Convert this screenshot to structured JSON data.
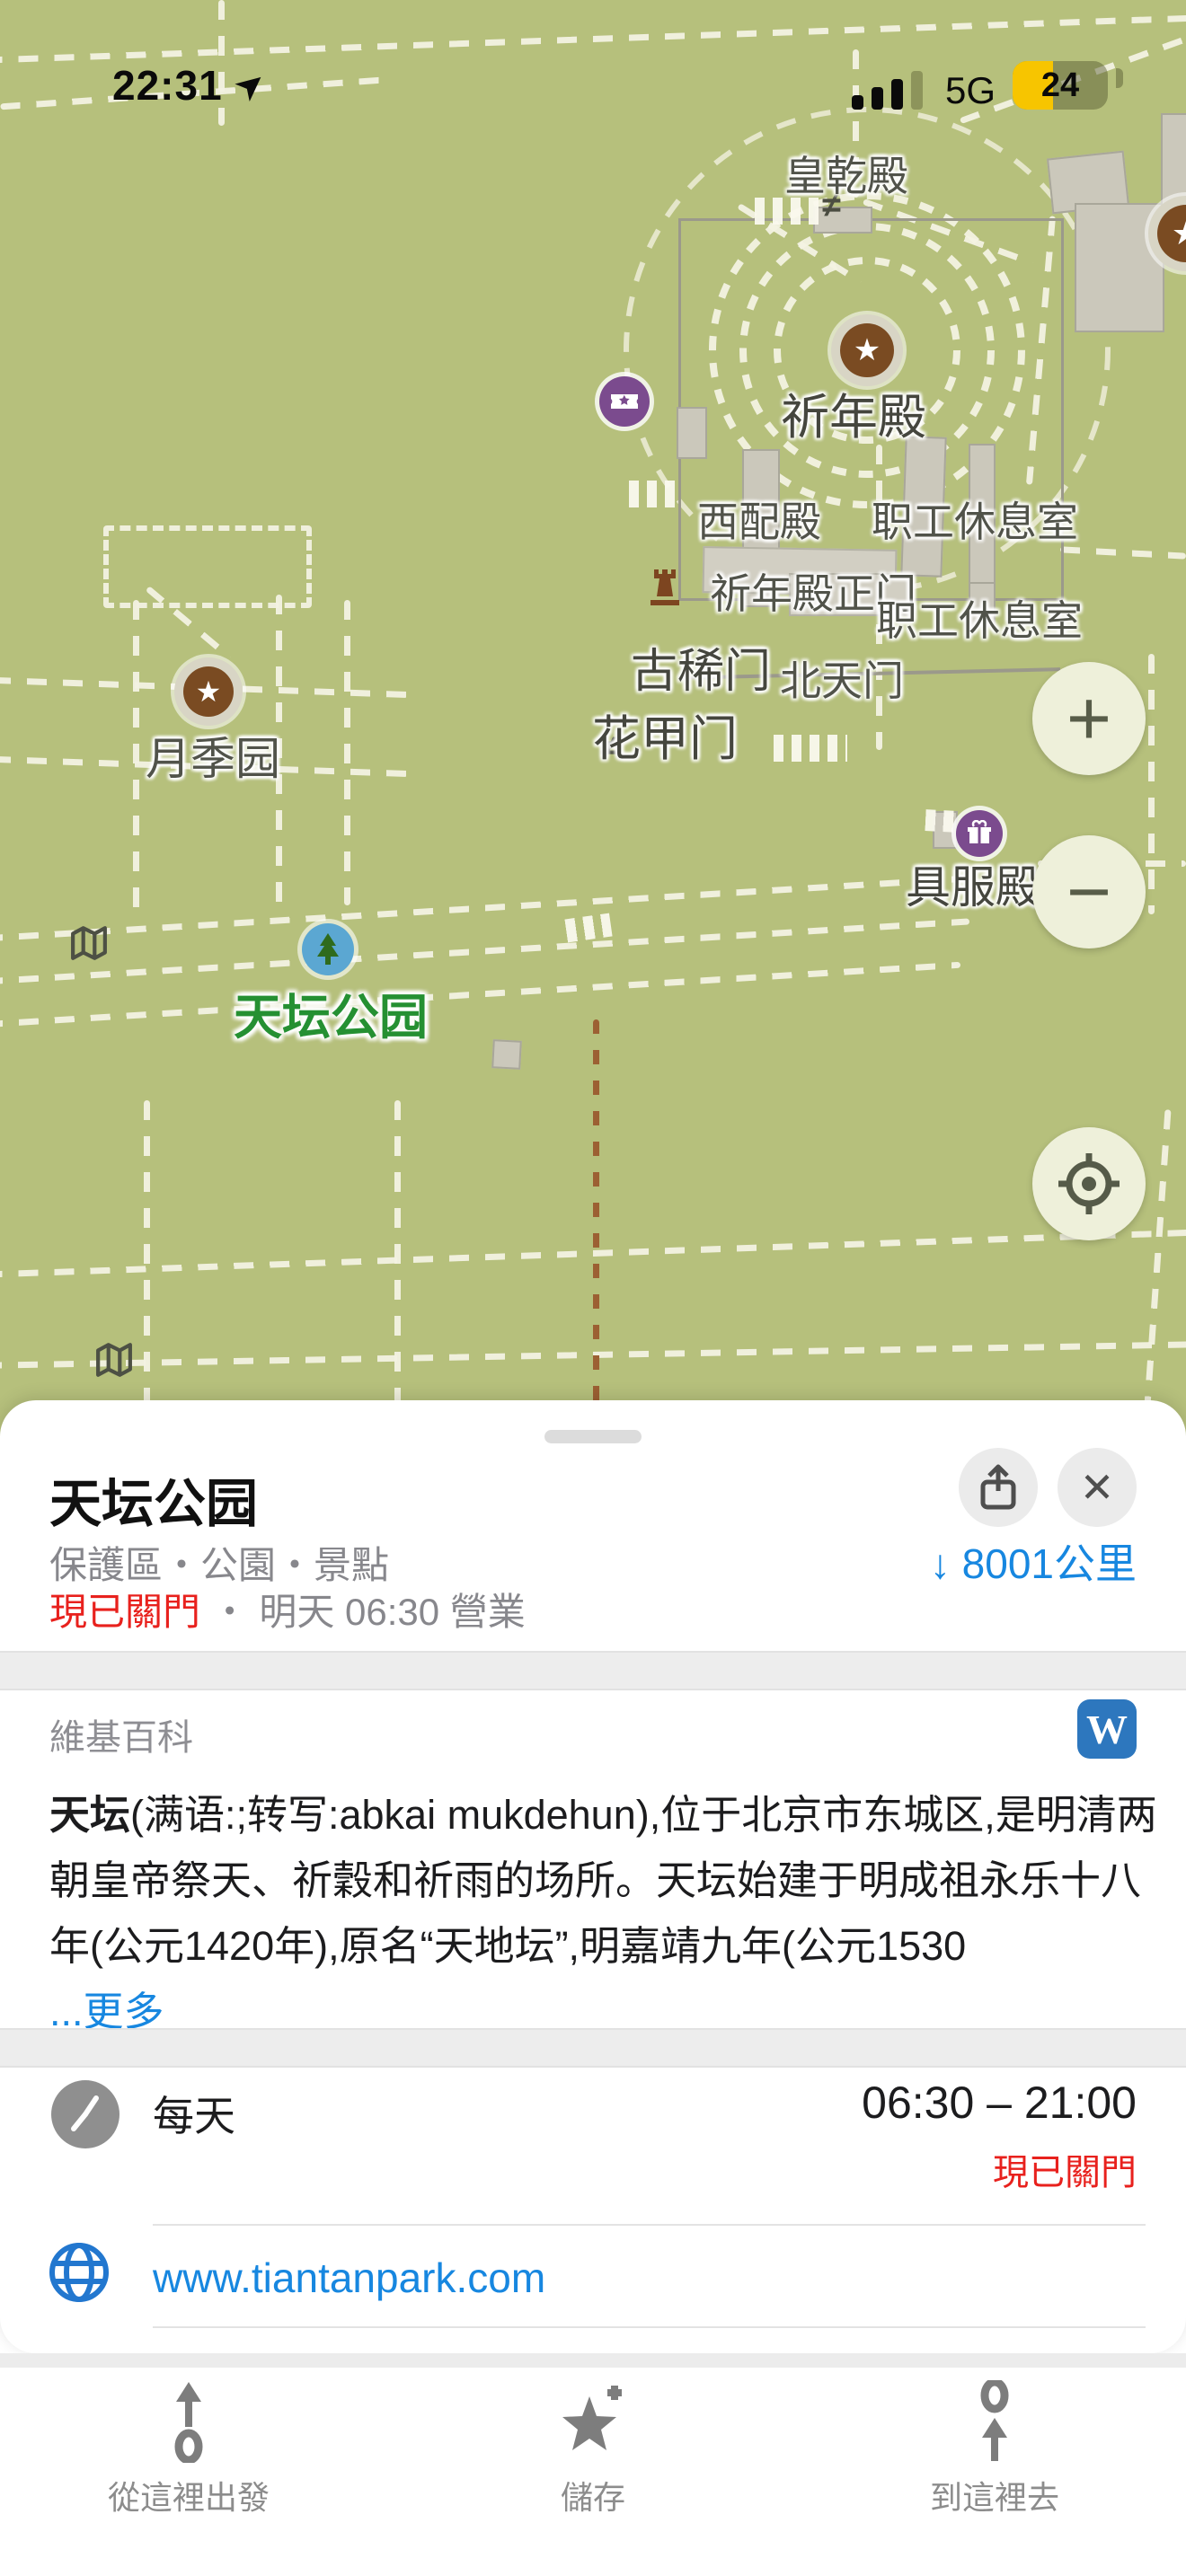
{
  "status_bar": {
    "time": "22:31",
    "network": "5G",
    "battery_percent": "24"
  },
  "map": {
    "place_labels": [
      {
        "text": "皇乾殿"
      },
      {
        "text": "祈年殿"
      },
      {
        "text": "西配殿"
      },
      {
        "text": "职工休息室"
      },
      {
        "text": "祈年殿正门"
      },
      {
        "text": "职工休息室"
      },
      {
        "text": "古稀门"
      },
      {
        "text": "北天门"
      },
      {
        "text": "花甲门"
      },
      {
        "text": "月季园"
      },
      {
        "text": "具服殿"
      }
    ],
    "park_label": "天坛公园",
    "neq_glyph": "≠",
    "star_glyph": "★",
    "controls": {
      "zoom_in": "+",
      "zoom_out": "−"
    }
  },
  "sheet": {
    "title": "天坛公园",
    "category": "保護區・公園・景點",
    "distance": {
      "arrow": "↓",
      "value": "8001公里"
    },
    "status": {
      "closed": "現已關門",
      "sep": " ・ ",
      "open_info": "明天 06:30 營業"
    },
    "wiki": {
      "heading": "維基百科",
      "w_letter": "W",
      "term": "天坛",
      "text_rest": "(满语:;转写:abkai mukdehun),位于北京市东城区,是明清两朝皇帝祭天、祈穀和祈雨的场所。天坛始建于明成祖永乐十八年(公元1420年),原名“天地坛”,明嘉靖九年(公元1530",
      "more": "...更多"
    },
    "hours": {
      "days": "每天",
      "range": "06:30 – 21:00",
      "status": "現已關門"
    },
    "website": "www.tiantanpark.com",
    "close_glyph": "✕"
  },
  "toolbar": {
    "items": [
      {
        "label": "從這裡出發"
      },
      {
        "label": "儲存"
      },
      {
        "label": "到這裡去"
      }
    ]
  },
  "colors": {
    "map_bg": "#b6c07c",
    "link_blue": "#1787e0",
    "closed_red": "#e8211d",
    "wiki_blue": "#2d77be",
    "poi_brown": "#7a4b22",
    "poi_purple": "#7b4b8e",
    "park_green": "#259032",
    "battery_yellow": "#f7c500"
  }
}
